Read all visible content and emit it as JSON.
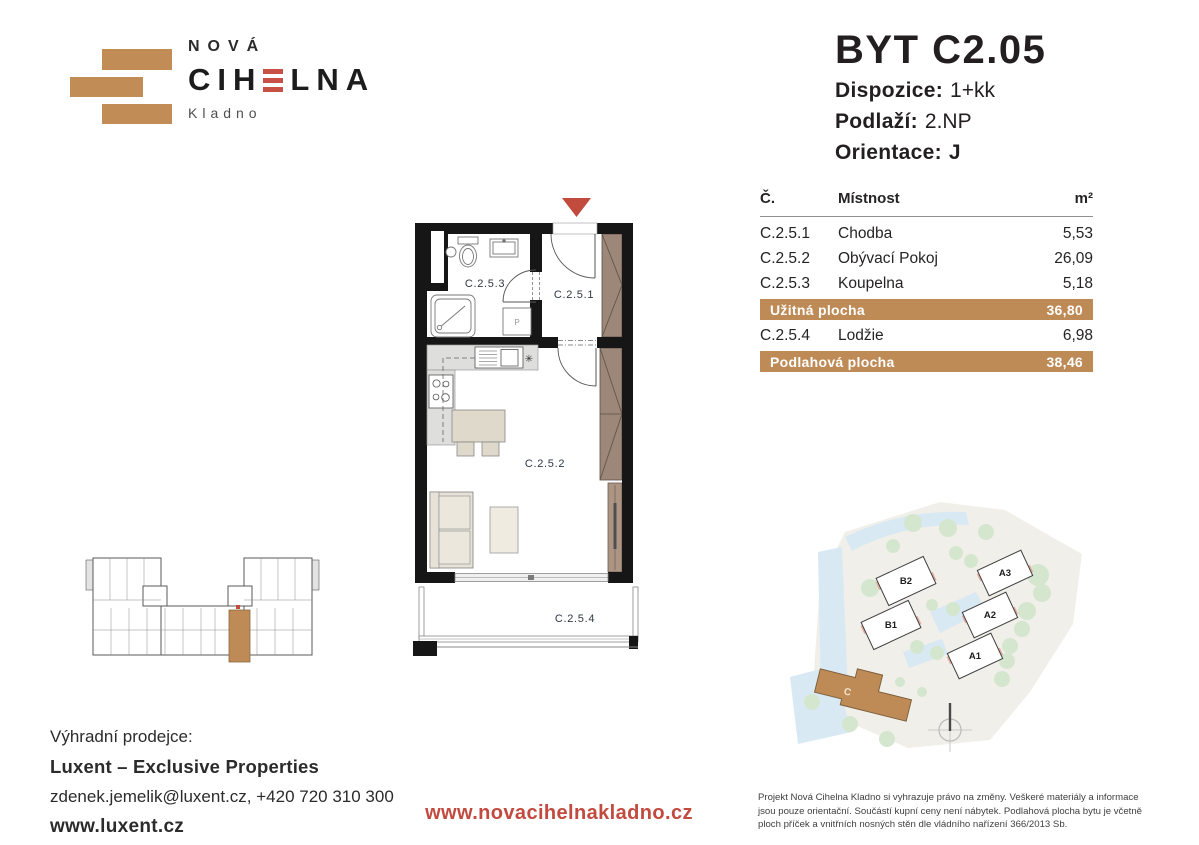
{
  "colors": {
    "accent_tan": "#BE8A55",
    "accent_red": "#C14B3C",
    "wood": "#9C8779",
    "label_dark": "#2E3944"
  },
  "logo": {
    "name_top": "NOVÁ",
    "name_pre": "CIH",
    "name_post": "LNA",
    "city": "Kladno"
  },
  "header": {
    "title": "BYT C2.05",
    "rows": [
      {
        "label": "Dispozice:",
        "value": "1+kk"
      },
      {
        "label": "Podlaží:",
        "value": "2.NP"
      },
      {
        "label": "Orientace:",
        "value": "J"
      }
    ]
  },
  "area_table": {
    "col_num": "Č.",
    "col_room": "Místnost",
    "col_area": "m²",
    "rows": [
      {
        "num": "C.2.5.1",
        "room": "Chodba",
        "area": "5,53"
      },
      {
        "num": "C.2.5.2",
        "room": "Obývací Pokoj",
        "area": "26,09"
      },
      {
        "num": "C.2.5.3",
        "room": "Koupelna",
        "area": "5,18"
      },
      {
        "num": "C.2.5.4",
        "room": "Lodžie",
        "area": "6,98"
      }
    ],
    "usable": {
      "label": "Užitná plocha",
      "value": "36,80"
    },
    "floor": {
      "label": "Podlahová plocha",
      "value": "38,46"
    }
  },
  "floorplan": {
    "room_hall": "C.2.5.1",
    "room_living": "C.2.5.2",
    "room_bath": "C.2.5.3",
    "room_loggia": "C.2.5.4",
    "washer": "P"
  },
  "siteplan": {
    "b2": "B2",
    "b1": "B1",
    "a3": "A3",
    "a2": "A2",
    "a1": "A1",
    "c": "C"
  },
  "footer": {
    "seller_intro": "Výhradní prodejce:",
    "seller_name": "Luxent – Exclusive Properties",
    "seller_contact": "zdenek.jemelik@luxent.cz, +420 720 310 300",
    "seller_web": "www.luxent.cz",
    "project_web": "www.novacihelnakladno.cz",
    "disclaimer": "Projekt Nová Cihelna Kladno si vyhrazuje právo na změny. Veškeré materiály a informace jsou pouze orientační. Součástí kupní ceny není nábytek. Podlahová plocha bytu je včetně ploch příček a vnitřních nosných stěn dle vládního nařízení 366/2013 Sb."
  }
}
